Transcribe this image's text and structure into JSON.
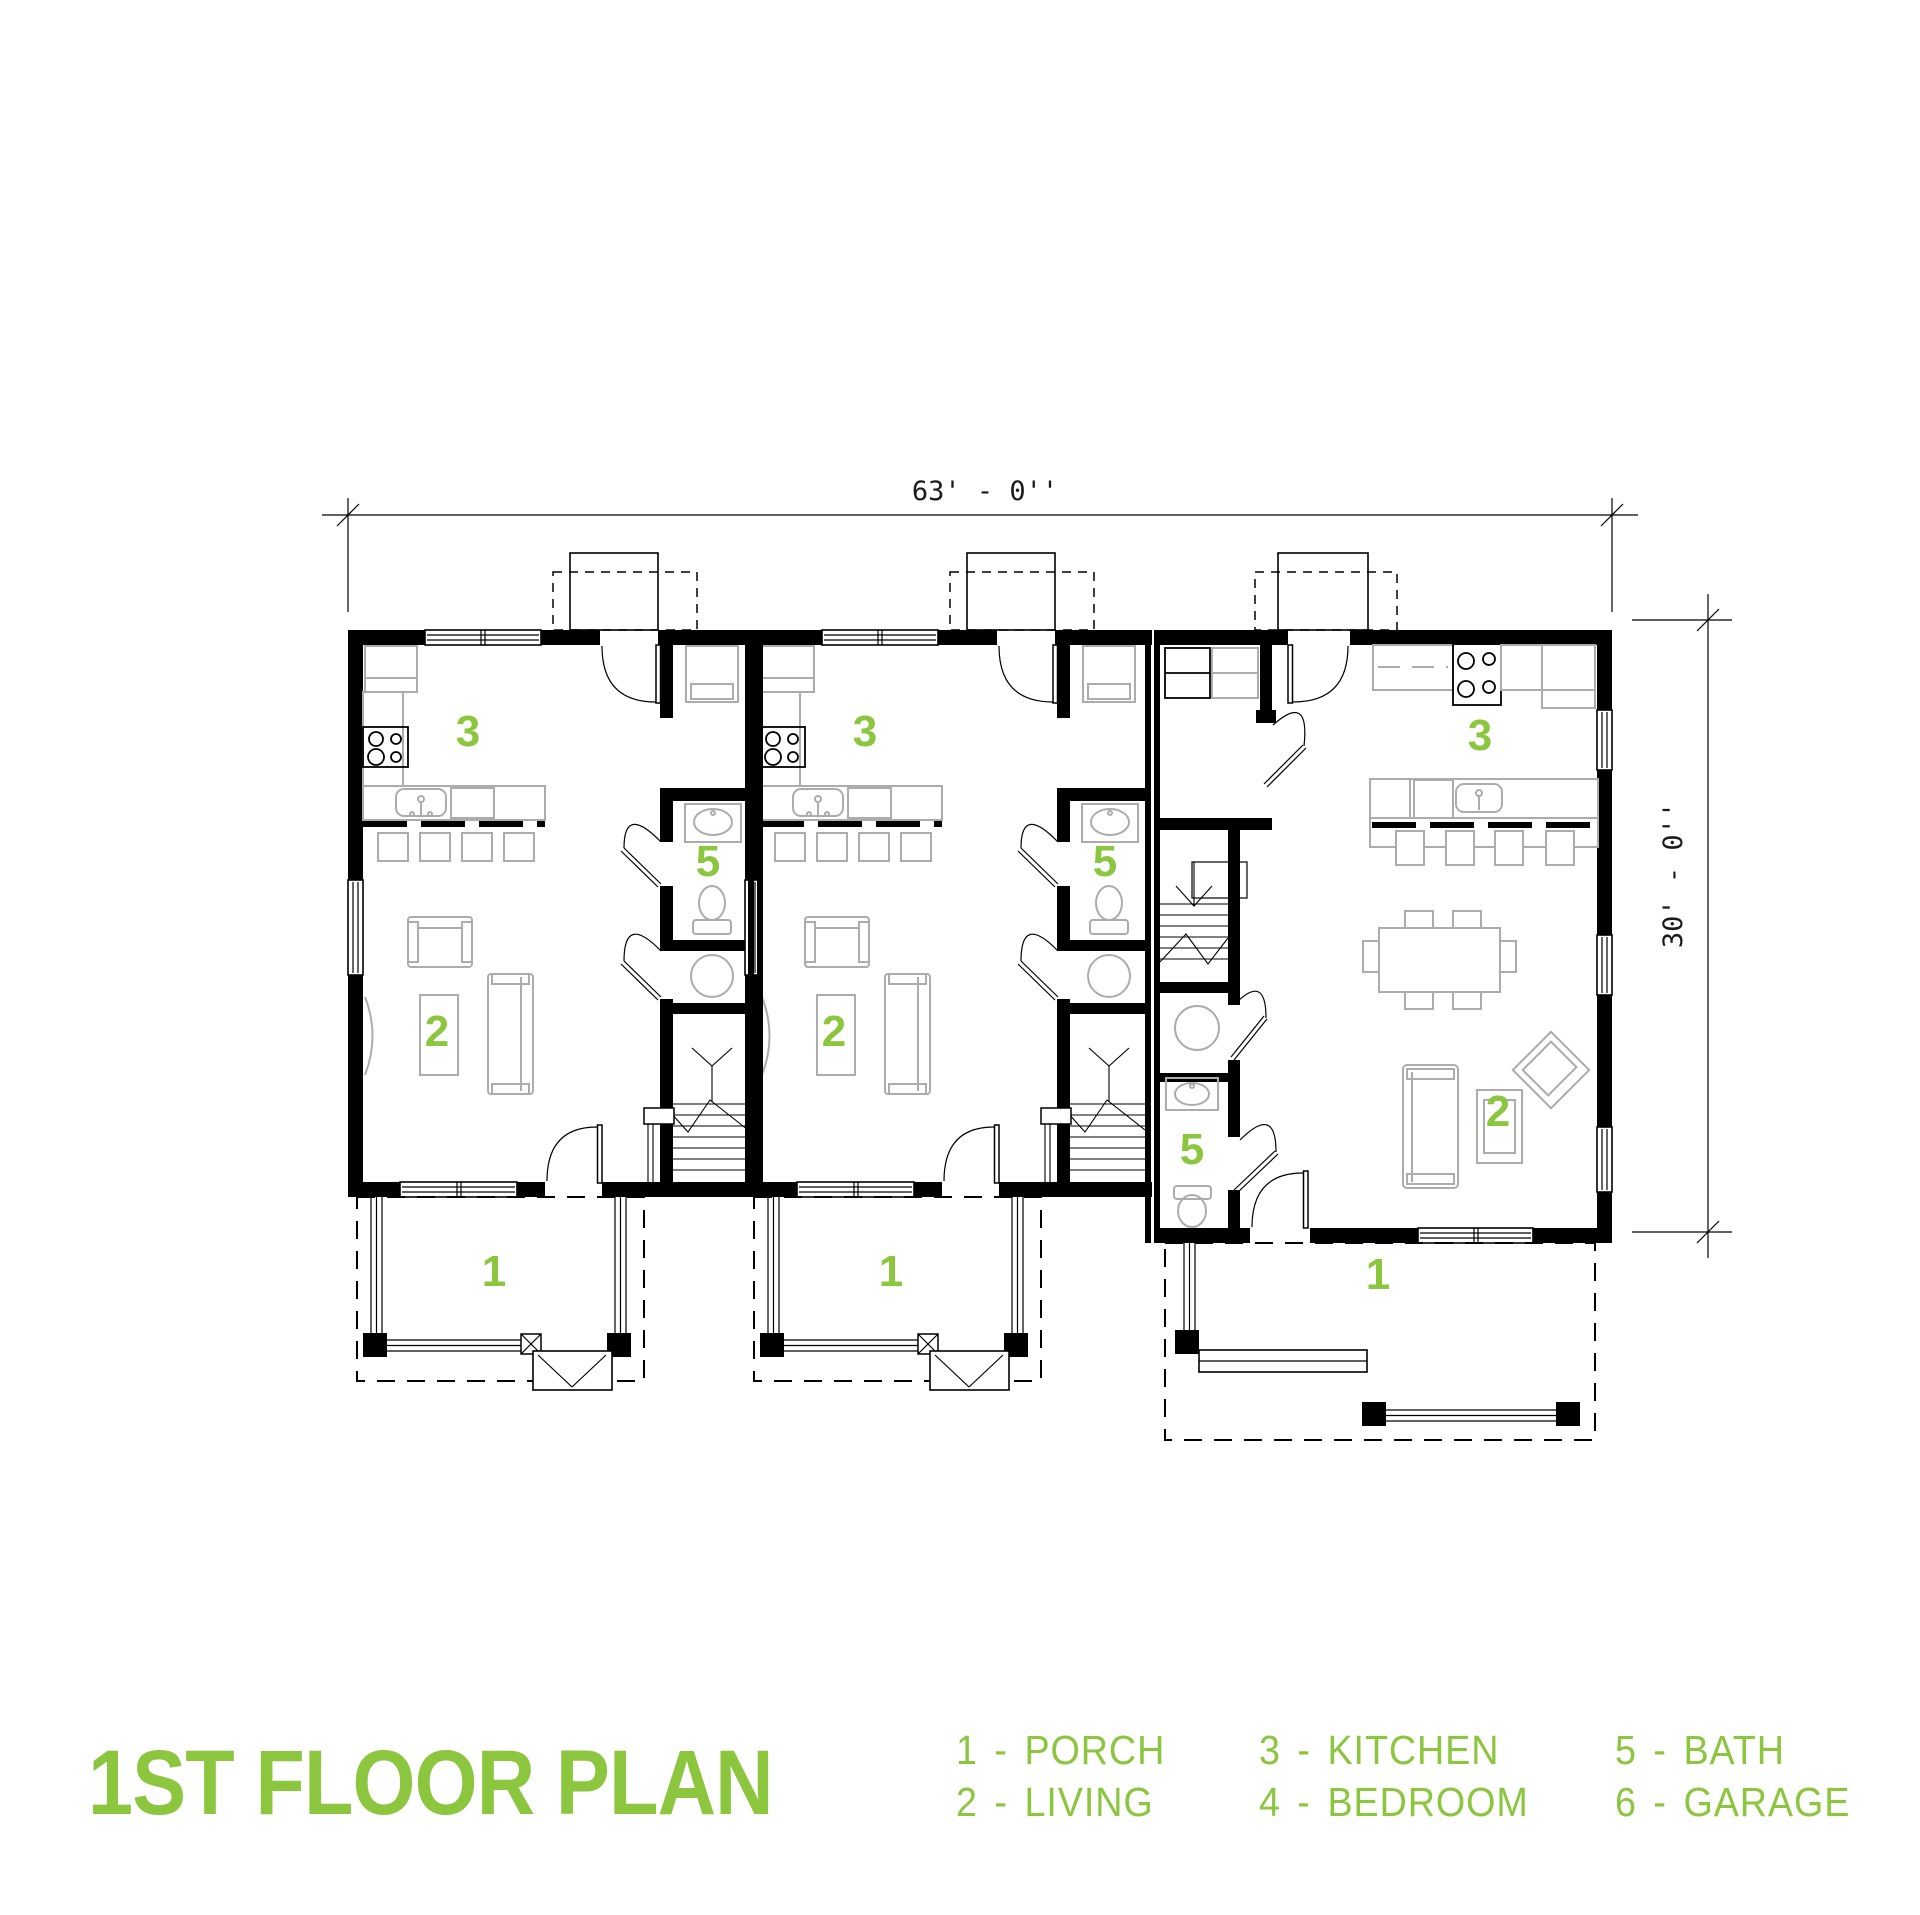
{
  "title": "1ST FLOOR PLAN",
  "plan": {
    "dimensions": {
      "width_label": "63' - 0''",
      "depth_label": "30' - 0''"
    },
    "room_numbers": {
      "porch": "1",
      "living": "2",
      "kitchen": "3",
      "bedroom": "4",
      "bath": "5",
      "garage": "6"
    }
  },
  "legend": {
    "separator": "-",
    "items": [
      {
        "num": "1",
        "name": "PORCH"
      },
      {
        "num": "2",
        "name": "LIVING"
      },
      {
        "num": "3",
        "name": "KITCHEN"
      },
      {
        "num": "4",
        "name": "BEDROOM"
      },
      {
        "num": "5",
        "name": "BATH"
      },
      {
        "num": "6",
        "name": "GARAGE"
      }
    ]
  },
  "colors": {
    "green": "#8CC63F",
    "wall": "#000000",
    "furn": "#ACACAC"
  }
}
